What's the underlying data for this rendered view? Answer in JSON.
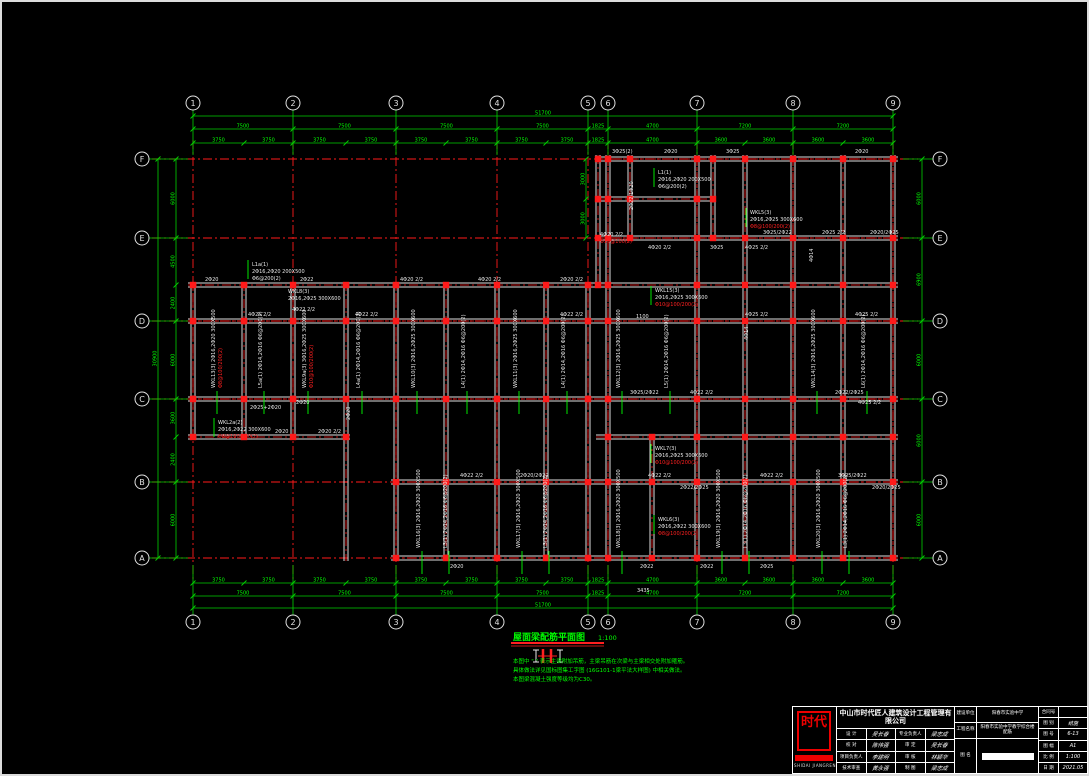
{
  "drawing": {
    "title": "屋面梁配筋平面图",
    "scale": "1:100",
    "notes": [
      "本图中 \"        \" 表示主梁附加吊筋，主梁吊筋在次梁与主梁相交处附加箍筋。",
      "具体做法详见国标图集工字图 (16G101-1梁平法大样图) 中相关做法。",
      "本图梁混凝土强度等级均为C30。"
    ],
    "colors": {
      "grid": "#ff1a1a",
      "dim": "#00d200",
      "dimtext": "#00ff00",
      "beam": "#dedede",
      "white": "#e8e8e8",
      "red": "#ff2020",
      "green": "#00ff00",
      "bubble": "#e0e0e0"
    },
    "grid": {
      "cols": [
        {
          "label": "1",
          "x": 193
        },
        {
          "label": "2",
          "x": 293
        },
        {
          "label": "3",
          "x": 396
        },
        {
          "label": "4",
          "x": 497
        },
        {
          "label": "5",
          "x": 588
        },
        {
          "label": "6",
          "x": 608
        },
        {
          "label": "7",
          "x": 697
        },
        {
          "label": "8",
          "x": 793
        },
        {
          "label": "9",
          "x": 893
        }
      ],
      "rows": [
        {
          "label": "F",
          "y": 159
        },
        {
          "label": "E",
          "y": 238
        },
        {
          "label": "D",
          "y": 321
        },
        {
          "label": "C",
          "y": 399
        },
        {
          "label": "B",
          "y": 482
        },
        {
          "label": "A",
          "y": 558
        }
      ],
      "bubble_top_y": 103,
      "bubble_bottom_y": 622,
      "bubble_left_x": 142,
      "bubble_right_x": 940
    },
    "dim_chains": [
      {
        "o": "h",
        "y": 116,
        "ticks": [
          193,
          893
        ],
        "values": [
          "51700"
        ]
      },
      {
        "o": "h",
        "y": 129,
        "ticks": [
          193,
          293,
          396,
          497,
          588,
          608,
          697,
          793,
          893
        ],
        "values": [
          "7500",
          "7500",
          "7500",
          "7500",
          "1825",
          "4700",
          "7200",
          "7200"
        ]
      },
      {
        "o": "h",
        "y": 143,
        "ticks": [
          193,
          244,
          293,
          346,
          396,
          446,
          497,
          546,
          588,
          608,
          697,
          745,
          793,
          843,
          893
        ],
        "values": [
          "3750",
          "3750",
          "3750",
          "3750",
          "3750",
          "3750",
          "3750",
          "3750",
          "1825",
          "4700",
          "3600",
          "3600",
          "3600",
          "3600"
        ]
      },
      {
        "o": "h",
        "y": 583,
        "ticks": [
          193,
          244,
          293,
          346,
          396,
          446,
          497,
          546,
          588,
          608,
          697,
          745,
          793,
          843,
          893
        ],
        "values": [
          "3750",
          "3750",
          "3750",
          "3750",
          "3750",
          "3750",
          "3750",
          "3750",
          "1825",
          "4700",
          "3600",
          "3600",
          "3600",
          "3600"
        ]
      },
      {
        "o": "h",
        "y": 596,
        "ticks": [
          193,
          293,
          396,
          497,
          588,
          608,
          697,
          793,
          893
        ],
        "values": [
          "7500",
          "7500",
          "7500",
          "7500",
          "1825",
          "4700",
          "7200",
          "7200"
        ]
      },
      {
        "o": "h",
        "y": 608,
        "ticks": [
          193,
          893
        ],
        "values": [
          "51700"
        ]
      },
      {
        "o": "v",
        "x": 158,
        "ticks": [
          159,
          558
        ],
        "values": [
          "30900"
        ]
      },
      {
        "o": "v",
        "x": 176,
        "ticks": [
          159,
          238,
          285,
          321,
          399,
          437,
          482,
          558
        ],
        "values": [
          "6000",
          "4500",
          "2400",
          "6000",
          "3600",
          "2400",
          "6000"
        ]
      },
      {
        "o": "v",
        "x": 922,
        "ticks": [
          159,
          238,
          321,
          399,
          482,
          558
        ],
        "values": [
          "6000",
          "6900",
          "6000",
          "6000",
          "6000"
        ]
      },
      {
        "o": "v",
        "x": 586,
        "ticks": [
          159,
          199,
          238
        ],
        "values": [
          "3000",
          "3000"
        ]
      }
    ],
    "beams": {
      "h": [
        [
          159,
          596,
          898
        ],
        [
          199,
          596,
          713
        ],
        [
          238,
          596,
          898
        ],
        [
          285,
          188,
          898
        ],
        [
          321,
          188,
          898
        ],
        [
          399,
          188,
          898
        ],
        [
          437,
          188,
          350
        ],
        [
          437,
          596,
          898
        ],
        [
          482,
          391,
          898
        ],
        [
          558,
          391,
          898
        ]
      ],
      "v": [
        [
          193,
          282,
          440
        ],
        [
          244,
          282,
          440
        ],
        [
          293,
          282,
          440
        ],
        [
          346,
          282,
          561
        ],
        [
          396,
          282,
          561
        ],
        [
          446,
          282,
          561
        ],
        [
          497,
          282,
          561
        ],
        [
          546,
          282,
          561
        ],
        [
          588,
          282,
          561
        ],
        [
          598,
          155,
          285
        ],
        [
          608,
          155,
          561
        ],
        [
          630,
          155,
          240
        ],
        [
          652,
          437,
          561
        ],
        [
          697,
          155,
          561
        ],
        [
          713,
          155,
          240
        ],
        [
          745,
          155,
          561
        ],
        [
          793,
          155,
          561
        ],
        [
          843,
          155,
          561
        ],
        [
          893,
          155,
          561
        ]
      ]
    },
    "annotations": [
      {
        "t": "3Φ25(2)",
        "x": 612,
        "y": 153
      },
      {
        "t": "2Φ20",
        "x": 664,
        "y": 153
      },
      {
        "t": "3Φ25",
        "x": 726,
        "y": 153
      },
      {
        "t": "2Φ20",
        "x": 855,
        "y": 153
      },
      {
        "t": "2Φ22/1Φ20",
        "x": 633,
        "y": 210,
        "r": -90
      },
      {
        "t": "L1(1)",
        "x": 658,
        "y": 174,
        "l": 1
      },
      {
        "t": "2Φ16,2Φ20 200X500",
        "x": 658,
        "y": 181
      },
      {
        "t": "Φ6@200(2)",
        "x": 658,
        "y": 188
      },
      {
        "t": "4Φ20 2/2",
        "x": 600,
        "y": 236
      },
      {
        "t": "Φ10@100(2)",
        "x": 600,
        "y": 243,
        "c": "r"
      },
      {
        "t": "4Φ20 2/2",
        "x": 648,
        "y": 249
      },
      {
        "t": "3Φ25",
        "x": 710,
        "y": 249
      },
      {
        "t": "3Φ25/2Φ22",
        "x": 763,
        "y": 234
      },
      {
        "t": "4Φ25 2/2",
        "x": 745,
        "y": 249
      },
      {
        "t": "2Φ25 2/2",
        "x": 822,
        "y": 234
      },
      {
        "t": "2Φ20/2Φ25",
        "x": 870,
        "y": 234
      },
      {
        "t": "WKL5(3)",
        "x": 750,
        "y": 214,
        "l": 1
      },
      {
        "t": "2Φ16,2Φ25 300X600",
        "x": 750,
        "y": 221
      },
      {
        "t": "Φ8@100/200(2)",
        "x": 750,
        "y": 228,
        "c": "r"
      },
      {
        "t": "4Φ14",
        "x": 813,
        "y": 262,
        "r": -90
      },
      {
        "t": "2Φ20",
        "x": 205,
        "y": 281
      },
      {
        "t": "2Φ22",
        "x": 300,
        "y": 281
      },
      {
        "t": "4Φ20 2/2",
        "x": 400,
        "y": 281
      },
      {
        "t": "4Φ20 2/2",
        "x": 478,
        "y": 281
      },
      {
        "t": "2Φ20 2/2",
        "x": 560,
        "y": 281
      },
      {
        "t": "L1a(1)",
        "x": 252,
        "y": 266,
        "l": 1
      },
      {
        "t": "2Φ16,2Φ20 200X500",
        "x": 252,
        "y": 273
      },
      {
        "t": "Φ6@200(2)",
        "x": 252,
        "y": 280
      },
      {
        "t": "WKL8(3)",
        "x": 288,
        "y": 293
      },
      {
        "t": "2Φ16,2Φ25 300X600",
        "x": 288,
        "y": 300
      },
      {
        "t": "4Φ25 2/2",
        "x": 248,
        "y": 316
      },
      {
        "t": "4Φ22 2/2",
        "x": 292,
        "y": 311
      },
      {
        "t": "4Φ22 2/2",
        "x": 355,
        "y": 316
      },
      {
        "t": "4Φ22 2/2",
        "x": 560,
        "y": 316
      },
      {
        "t": "1100",
        "x": 636,
        "y": 318
      },
      {
        "t": "4Φ25 2/2",
        "x": 745,
        "y": 316
      },
      {
        "t": "4Φ25 2/2",
        "x": 855,
        "y": 316
      },
      {
        "t": "WKL15(3)",
        "x": 655,
        "y": 292,
        "l": 1
      },
      {
        "t": "2Φ16,2Φ25 300X600",
        "x": 655,
        "y": 299
      },
      {
        "t": "Φ10@100/200(2)",
        "x": 655,
        "y": 306,
        "c": "r"
      },
      {
        "t": "WKL13(3) 2Φ16,2Φ20 300X500",
        "x": 215,
        "y": 388,
        "r": -90,
        "l": 1
      },
      {
        "t": "Φ8@100/200(2)",
        "x": 222,
        "y": 388,
        "r": -90,
        "c": "r"
      },
      {
        "t": "L5a(1) 2Φ14,2Φ16 Φ6@200(2)",
        "x": 262,
        "y": 388,
        "r": -90,
        "l": 1
      },
      {
        "t": "WKL9a(3) 3Φ16,2Φ25 300X600",
        "x": 306,
        "y": 388,
        "r": -90,
        "l": 1
      },
      {
        "t": "Φ10@100/200(2)",
        "x": 313,
        "y": 388,
        "r": -90,
        "c": "r"
      },
      {
        "t": "L4a(1) 2Φ14,2Φ16 Φ6@200(2)",
        "x": 360,
        "y": 388,
        "r": -90,
        "l": 1
      },
      {
        "t": "WKL10(3) 2Φ16,2Φ25 300X600",
        "x": 415,
        "y": 388,
        "r": -90,
        "l": 1
      },
      {
        "t": "L4(1) 2Φ14,2Φ16 Φ6@200(2)",
        "x": 465,
        "y": 388,
        "r": -90,
        "l": 1
      },
      {
        "t": "WKL11(3) 2Φ16,2Φ25 300X600",
        "x": 517,
        "y": 388,
        "r": -90,
        "l": 1
      },
      {
        "t": "L4(1) 2Φ14,2Φ16 Φ6@200(2)",
        "x": 565,
        "y": 388,
        "r": -90,
        "l": 1
      },
      {
        "t": "WKL12(3) 2Φ16,2Φ25 300X600",
        "x": 620,
        "y": 388,
        "r": -90,
        "l": 1
      },
      {
        "t": "L5(1) 2Φ14,2Φ16 Φ6@200(2)",
        "x": 668,
        "y": 388,
        "r": -90,
        "l": 1
      },
      {
        "t": "4Φ14",
        "x": 748,
        "y": 340,
        "r": -90
      },
      {
        "t": "WKL14(3) 2Φ16,2Φ25 300X600",
        "x": 815,
        "y": 388,
        "r": -90,
        "l": 1
      },
      {
        "t": "L6(1) 2Φ14,2Φ16 Φ6@200(2)",
        "x": 865,
        "y": 388,
        "r": -90,
        "l": 1
      },
      {
        "t": "2Φ25+2Φ20",
        "x": 250,
        "y": 409
      },
      {
        "t": "2Φ20",
        "x": 296,
        "y": 404
      },
      {
        "t": "2Φ20",
        "x": 350,
        "y": 420,
        "r": -90
      },
      {
        "t": "3Φ25/2Φ22",
        "x": 630,
        "y": 394
      },
      {
        "t": "4Φ22 2/2",
        "x": 690,
        "y": 394
      },
      {
        "t": "2Φ22/2Φ25",
        "x": 835,
        "y": 394
      },
      {
        "t": "4Φ25 2/2",
        "x": 858,
        "y": 404
      },
      {
        "t": "WKL2a(2)",
        "x": 218,
        "y": 424,
        "l": 1
      },
      {
        "t": "2Φ16,2Φ22 300X600",
        "x": 218,
        "y": 431
      },
      {
        "t": "Φ8@100/200(2)",
        "x": 218,
        "y": 438,
        "c": "r"
      },
      {
        "t": "2Φ20",
        "x": 275,
        "y": 433
      },
      {
        "t": "2Φ20 2/2",
        "x": 318,
        "y": 433
      },
      {
        "t": "4Φ22 2/2",
        "x": 460,
        "y": 477
      },
      {
        "t": "2Φ20/2Φ22",
        "x": 520,
        "y": 477
      },
      {
        "t": "4Φ22 2/2",
        "x": 648,
        "y": 477
      },
      {
        "t": "2Φ22/2Φ25",
        "x": 680,
        "y": 489
      },
      {
        "t": "4Φ22 2/2",
        "x": 760,
        "y": 477
      },
      {
        "t": "3Φ25/2Φ22",
        "x": 838,
        "y": 477
      },
      {
        "t": "2Φ20/2Φ25",
        "x": 872,
        "y": 489
      },
      {
        "t": "WKL7(3)",
        "x": 655,
        "y": 450,
        "l": 1
      },
      {
        "t": "2Φ16,2Φ25 300X600",
        "x": 655,
        "y": 457
      },
      {
        "t": "Φ10@100/200(2)",
        "x": 655,
        "y": 464,
        "c": "r"
      },
      {
        "t": "WKL16(3) 2Φ16,2Φ20 300X500",
        "x": 420,
        "y": 548,
        "r": -90,
        "l": 1
      },
      {
        "t": "L3(1) 2Φ14,2Φ16 Φ6@200(2)",
        "x": 447,
        "y": 548,
        "r": -90,
        "l": 1
      },
      {
        "t": "WKL17(3) 2Φ16,2Φ20 300X500",
        "x": 520,
        "y": 548,
        "r": -90,
        "l": 1
      },
      {
        "t": "L3(1) 2Φ14,2Φ16 Φ6@200(2)",
        "x": 547,
        "y": 548,
        "r": -90,
        "l": 1
      },
      {
        "t": "WKL18(3) 2Φ16,2Φ20 300X500",
        "x": 620,
        "y": 548,
        "r": -90,
        "l": 1
      },
      {
        "t": "WKL19(3) 2Φ16,2Φ20 300X500",
        "x": 720,
        "y": 548,
        "r": -90,
        "l": 1
      },
      {
        "t": "L3(1) 2Φ14,2Φ16 Φ6@200(2)",
        "x": 747,
        "y": 548,
        "r": -90,
        "l": 1
      },
      {
        "t": "WKL20(3) 2Φ16,2Φ20 300X500",
        "x": 820,
        "y": 548,
        "r": -90,
        "l": 1
      },
      {
        "t": "L3(1) 2Φ14,2Φ16 Φ6@200(2)",
        "x": 847,
        "y": 548,
        "r": -90,
        "l": 1
      },
      {
        "t": "WKL6(3)",
        "x": 658,
        "y": 521,
        "l": 1
      },
      {
        "t": "2Φ16,2Φ22 300X600",
        "x": 658,
        "y": 528
      },
      {
        "t": "Φ8@100/200(2)",
        "x": 658,
        "y": 535,
        "c": "r"
      },
      {
        "t": "2Φ20",
        "x": 450,
        "y": 568
      },
      {
        "t": "2Φ22",
        "x": 640,
        "y": 568
      },
      {
        "t": "2Φ22",
        "x": 700,
        "y": 568
      },
      {
        "t": "2Φ25",
        "x": 760,
        "y": 568
      },
      {
        "t": "3435",
        "x": 637,
        "y": 592
      }
    ]
  },
  "titleblock": {
    "company": "中山市时代匠人建筑设计工程管理有限公司",
    "logo_text": "时代",
    "logo_sub": "SHIDAI JIANGREN",
    "sig_rows": [
      [
        "设 计",
        "吴长春",
        "专业负责人",
        "梁志成"
      ],
      [
        "校 对",
        "陈伟强",
        "审 定",
        "吴长春"
      ],
      [
        "项目负责人",
        "李建明",
        "审 核",
        "林颖华"
      ],
      [
        "技术审查",
        "黄永强",
        "制 图",
        "梁志成"
      ]
    ],
    "proj": {
      "owner_label": "建设单位",
      "owner_value": "阳春市实验中学",
      "project_label": "工程名称",
      "project_value": "阳春市实验中学教学综合楼 配筋",
      "name_label": "图 名"
    },
    "meta_rows": [
      [
        "合同号",
        ""
      ],
      [
        "图 别",
        "结施"
      ],
      [
        "图 号",
        "6-13"
      ],
      [
        "图 幅",
        "A1"
      ],
      [
        "比 例",
        "1:100"
      ],
      [
        "日 期",
        "2021.05"
      ]
    ]
  }
}
